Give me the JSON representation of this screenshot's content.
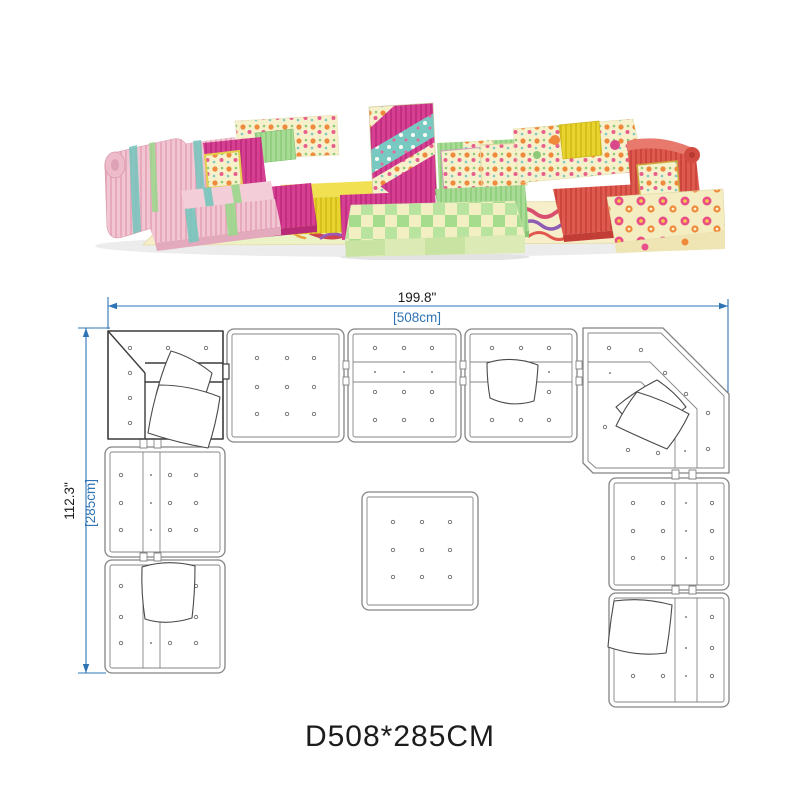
{
  "photo": {
    "alt": "colorful patchwork modular floor sofa set",
    "palette": {
      "pink": "#f1c6d2",
      "magenta": "#d63f92",
      "yellow": "#e8d42f",
      "green": "#a8dc96",
      "red": "#df5a4e",
      "cream_floral": "#f6f0cb",
      "teal": "#79c9c3"
    }
  },
  "plan": {
    "width_in": "199.8\"",
    "width_cm": "[508cm]",
    "height_in": "112.3\"",
    "height_cm": "[285cm]",
    "dimension_color": "#2e74b5",
    "outline_color": "#848484",
    "modules": {
      "top_row": 5,
      "left_column": 2,
      "right_column": 2,
      "center_ottoman": 1
    }
  },
  "caption": {
    "text": "D508*285CM"
  }
}
